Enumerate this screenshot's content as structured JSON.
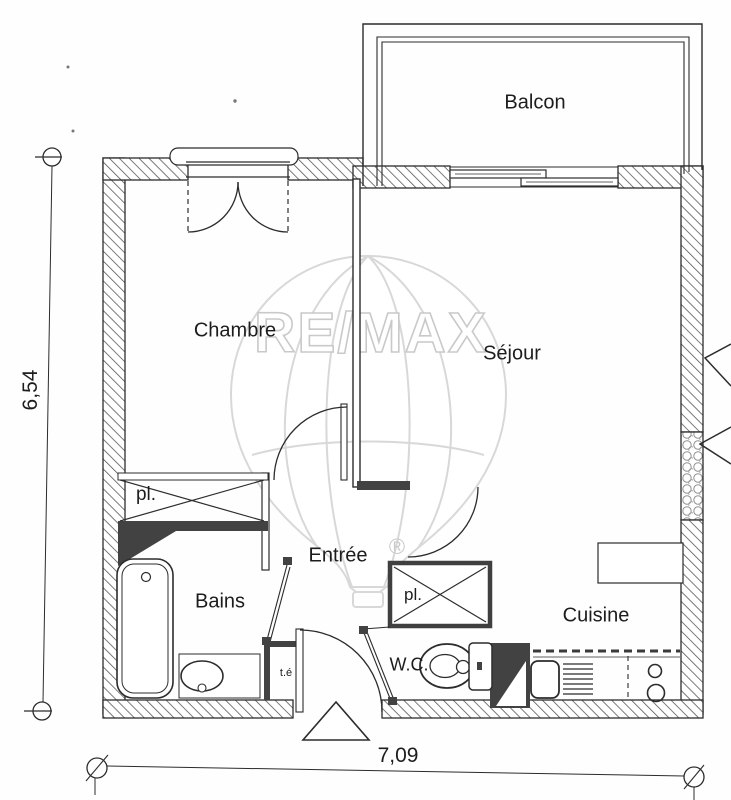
{
  "plan": {
    "rooms": [
      {
        "name": "balcon",
        "label": "Balcon"
      },
      {
        "name": "chambre",
        "label": "Chambre"
      },
      {
        "name": "sejour",
        "label": "Séjour"
      },
      {
        "name": "entree",
        "label": "Entrée"
      },
      {
        "name": "bains",
        "label": "Bains"
      },
      {
        "name": "wc",
        "label": "W.C."
      },
      {
        "name": "cuisine",
        "label": "Cuisine"
      }
    ],
    "closets": [
      {
        "name": "placard-chambre",
        "label": "pl."
      },
      {
        "name": "placard-wc",
        "label": "pl."
      }
    ],
    "utility": {
      "label": "t.é"
    },
    "dimensions": {
      "width": "7,09",
      "height": "6,54"
    },
    "watermark": {
      "brand": "RE/MAX",
      "registered": "®"
    },
    "colors": {
      "ink": "#2c2c2c",
      "dark_wall": "#424242",
      "watermark_line": "#d8d8d8",
      "paper": "#fefefe"
    }
  }
}
